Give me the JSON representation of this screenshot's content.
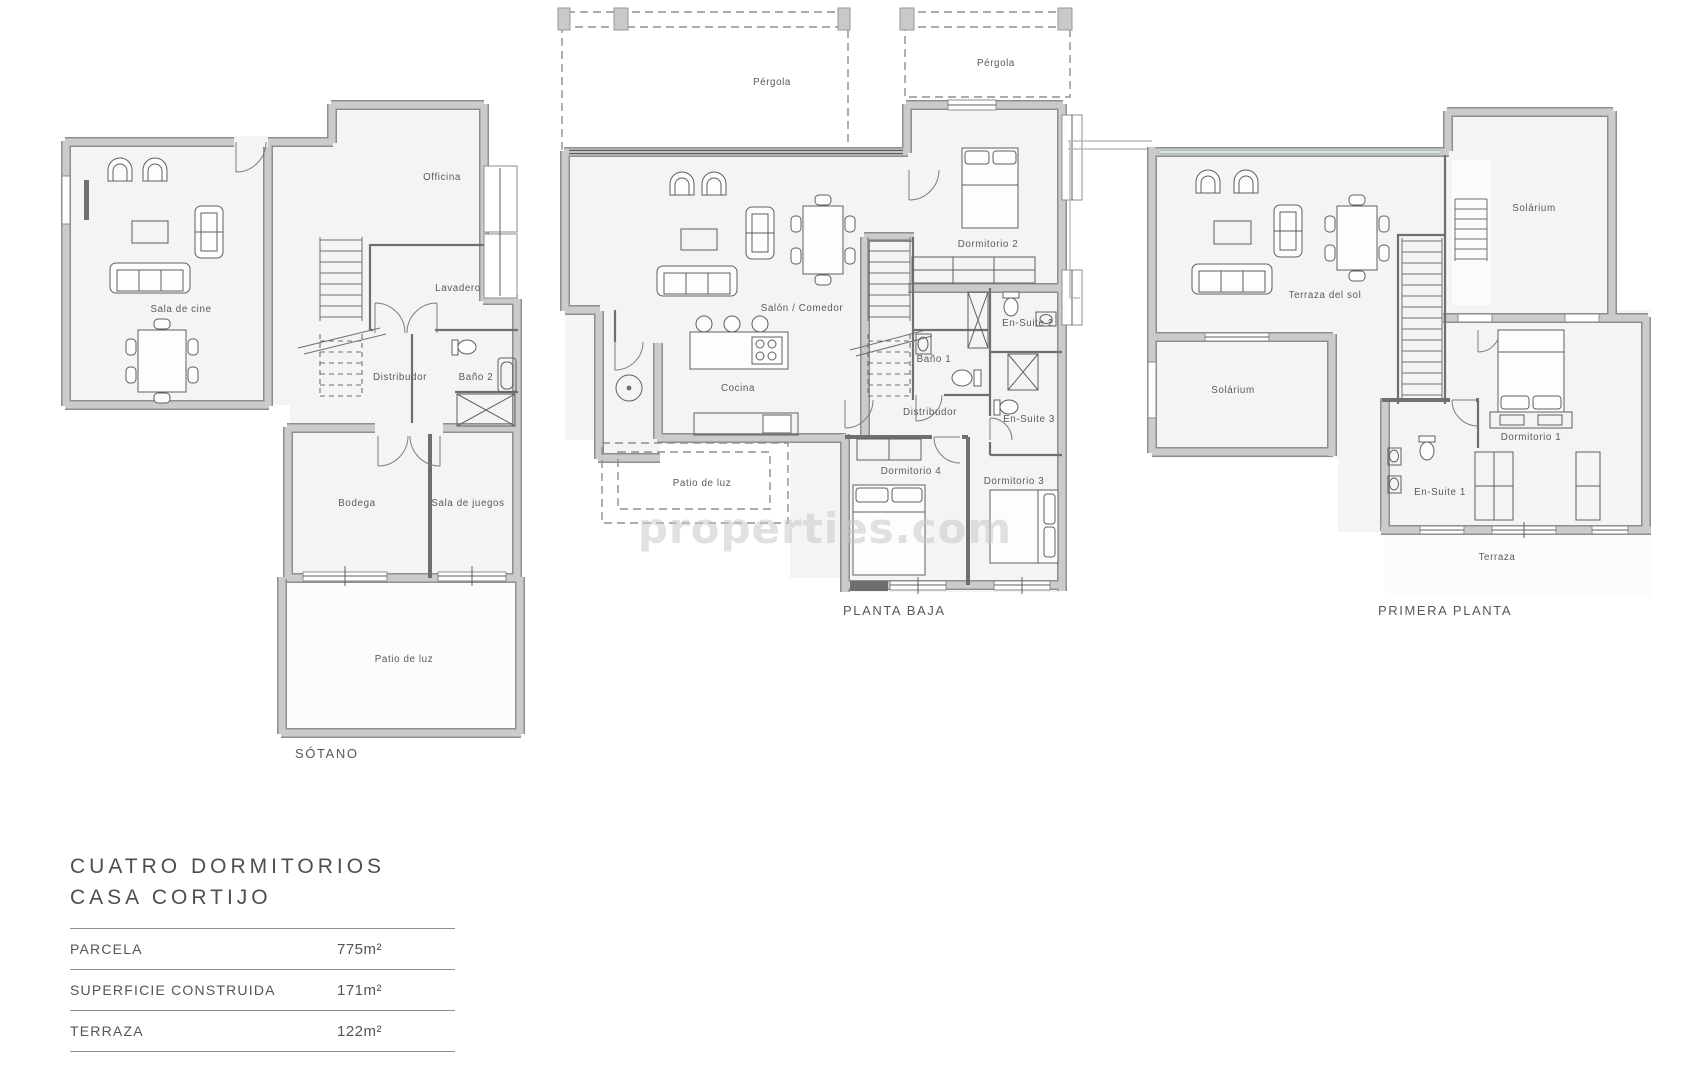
{
  "watermark": {
    "text": "properties.com"
  },
  "plans": {
    "sotano": {
      "caption": "SÓTANO",
      "rooms": {
        "sala_de_cine": "Sala de cine",
        "officina": "Officina",
        "lavadero": "Lavadero",
        "distribudor": "Distribudor",
        "bano_2": "Baño 2",
        "bodega": "Bodega",
        "sala_de_juegos": "Sala de juegos",
        "patio_de_luz": "Patio de luz"
      }
    },
    "planta_baja": {
      "caption": "PLANTA BAJA",
      "rooms": {
        "pergola_1": "Pérgola",
        "pergola_2": "Pérgola",
        "salon_comedor": "Salón / Comedor",
        "cocina": "Cocina",
        "patio_de_luz": "Patio de luz",
        "dormitorio_2": "Dormitorio 2",
        "en_suite_2": "En-Suite 2",
        "bano_1": "Baño 1",
        "distribudor": "Distribudor",
        "en_suite_3": "En-Suite 3",
        "dormitorio_4": "Dormitorio 4",
        "dormitorio_3": "Dormitorio 3"
      }
    },
    "primera_planta": {
      "caption": "PRIMERA PLANTA",
      "rooms": {
        "terraza_del_sol": "Terraza del sol",
        "solarium_top": "Solárium",
        "solarium_left": "Solárium",
        "dormitorio_1": "Dormitorio 1",
        "en_suite_1": "En-Suite 1",
        "terraza": "Terraza"
      }
    }
  },
  "legend": {
    "title_line1": "CUATRO DORMITORIOS",
    "title_line2": "CASA CORTIJO",
    "rows": [
      {
        "label": "PARCELA",
        "value": "775m²"
      },
      {
        "label": "SUPERFICIE CONSTRUIDA",
        "value": "171m²"
      },
      {
        "label": "TERRAZA",
        "value": "122m²"
      }
    ]
  },
  "colors": {
    "wall_fill": "#cbcbcb",
    "wall_edge": "#8f8f8f",
    "partition": "#6f6f6f",
    "floor": "#f4f4f4",
    "furniture_line": "#5f5f5f",
    "glass": "#9fb9bd",
    "label_text": "#5a5a5a",
    "watermark": "#c9c9c9"
  }
}
